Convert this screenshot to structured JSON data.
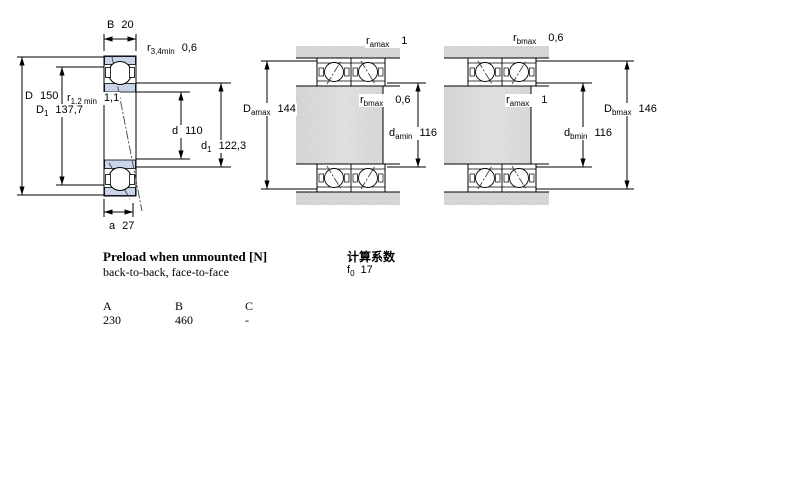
{
  "colors": {
    "bearing_section_fill": "#ccd7ec",
    "bearing_section_dot": "#a9bcdd",
    "steel_fill": "#d7d7d7",
    "steel_dot": "#c3c3c3",
    "line": "#000000"
  },
  "dims": {
    "B": {
      "base": "B",
      "sub": "",
      "value": "20"
    },
    "r34": {
      "base": "r",
      "sub": "3,4min",
      "value": "0,6"
    },
    "D": {
      "base": "D",
      "sub": "",
      "value": "150"
    },
    "r12": {
      "base": "r",
      "sub": "1,2 min",
      "value": "1,1"
    },
    "D1": {
      "base": "D",
      "sub": "1",
      "value": "137,7"
    },
    "d": {
      "base": "d",
      "sub": "",
      "value": "110"
    },
    "d1": {
      "base": "d",
      "sub": "1",
      "value": "122,3"
    },
    "a": {
      "base": "a",
      "sub": "",
      "value": "27"
    },
    "ramax_m": {
      "base": "r",
      "sub": "amax",
      "value": "1"
    },
    "rbmax_m": {
      "base": "r",
      "sub": "bmax",
      "value": "0,6"
    },
    "Damax": {
      "base": "D",
      "sub": "amax",
      "value": "144"
    },
    "damin": {
      "base": "d",
      "sub": "amin",
      "value": "116"
    },
    "rbmax_r": {
      "base": "r",
      "sub": "bmax",
      "value": "0,6"
    },
    "ramax_r": {
      "base": "r",
      "sub": "amax",
      "value": "1"
    },
    "Dbmax": {
      "base": "D",
      "sub": "bmax",
      "value": "146"
    },
    "dbmin": {
      "base": "d",
      "sub": "bmin",
      "value": "116"
    }
  },
  "notes": {
    "preload_title": "Preload when unmounted [N]",
    "preload_subtitle": "back-to-back, face-to-face",
    "calc_title": "计算系数",
    "f0": {
      "base": "f",
      "sub": "0",
      "value": "17"
    }
  },
  "preload_table": {
    "headers": [
      "A",
      "B",
      "C"
    ],
    "values": [
      "230",
      "460",
      "-"
    ]
  }
}
